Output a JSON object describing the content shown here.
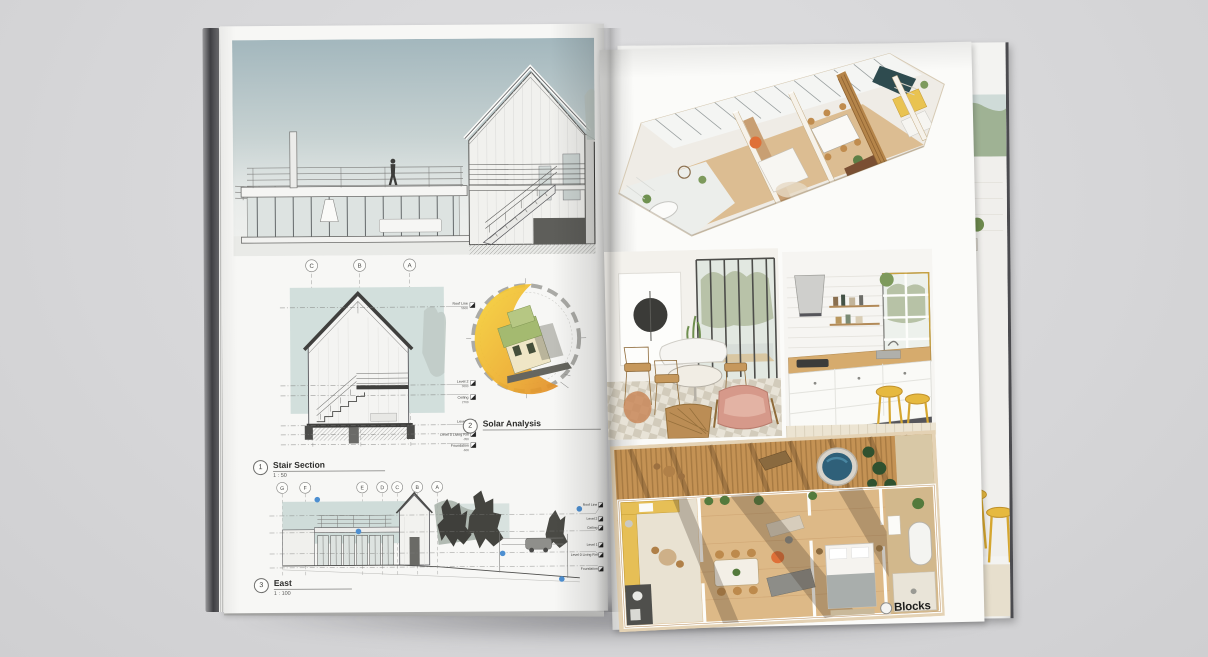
{
  "left_page": {
    "figures": [
      {
        "number": "1",
        "title": "Stair Section",
        "scale": "1 : 50"
      },
      {
        "number": "2",
        "title": "Solar Analysis",
        "scale": ""
      },
      {
        "number": "3",
        "title": "East",
        "scale": "1 : 100"
      }
    ],
    "stair_grid_bubbles": [
      "C",
      "B",
      "A"
    ],
    "east_grid_bubbles": [
      "G",
      "F",
      "E",
      "D",
      "C",
      "B",
      "A"
    ],
    "levels": [
      {
        "label": "Roof Line",
        "elev": "5600"
      },
      {
        "label": "Level 2",
        "elev": "3000"
      },
      {
        "label": "Ceiling",
        "elev": "2700"
      },
      {
        "label": "Level 1",
        "elev": "0"
      },
      {
        "label": "Level 0 Living Rm",
        "elev": "-350"
      },
      {
        "label": "Foundation",
        "elev": "-600"
      }
    ]
  },
  "right_page": {
    "logo_text": "Blocks"
  },
  "colors": {
    "background": "#d6d6d8",
    "page": "#f7f7f5",
    "drawing_teal": "#d2dfdc",
    "solar_yellow": "#f2cd3a",
    "solar_orange": "#e08b27",
    "wood": "#c49254",
    "kitchen_yellow": "#e8c351",
    "hot_tub_blue": "#2f6079",
    "accent_teal_wall": "#2e4b4f",
    "keynote_blue": "#4d8fd1"
  }
}
